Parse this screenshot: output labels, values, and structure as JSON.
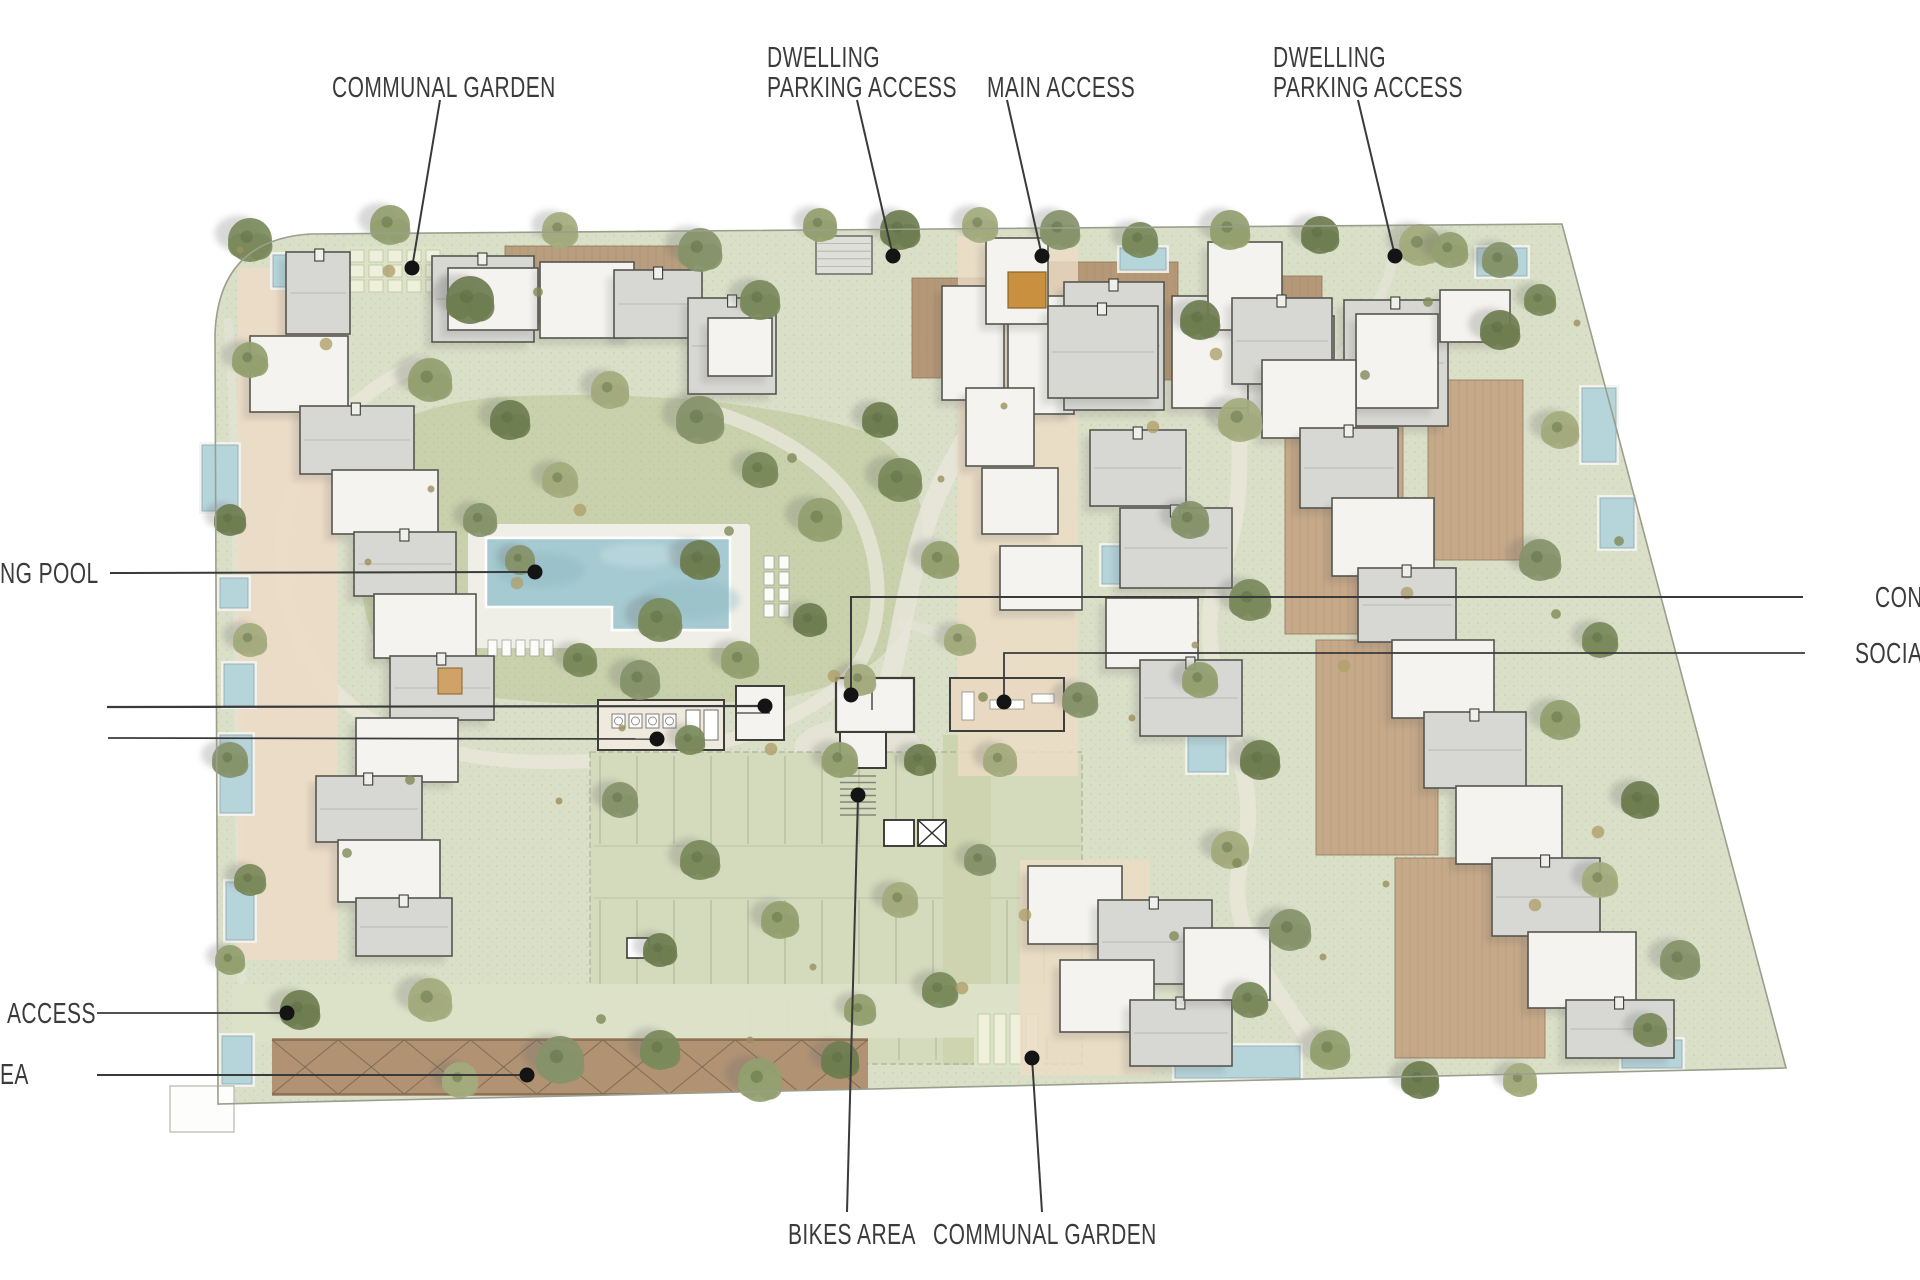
{
  "title": "Residential masterplan site plan",
  "annotations": {
    "communal_garden_top": {
      "label": "COMMUNAL GARDEN"
    },
    "dwelling_parking_left": {
      "line1": "DWELLING",
      "line2": "PARKING ACCESS"
    },
    "main_access": {
      "label": "MAIN ACCESS"
    },
    "dwelling_parking_right": {
      "line1": "DWELLING",
      "line2": "PARKING ACCESS"
    },
    "swimming_pool": {
      "label": "NG POOL"
    },
    "access": {
      "label": "ACCESS"
    },
    "area": {
      "label": "EA"
    },
    "concierge": {
      "label": "CON"
    },
    "social": {
      "label": "SOCIA"
    },
    "bikes_area": {
      "label": "BIKES AREA"
    },
    "communal_garden_bottom": {
      "label": "COMMUNAL GARDEN"
    }
  },
  "palette": {
    "site_green": "#dadfc8",
    "lawn_green": "#c5cfa7",
    "parking_green": "#d4dabc",
    "aisle_green": "#ccd4ae",
    "lane_green": "#dce1c8",
    "path_grey": "#e8e6da",
    "plaza_grey": "#e6e4d7",
    "deck_beige": "#ecdcc6",
    "deck_brown": "#b29573",
    "deck_brown2": "#b79b7b",
    "deck_tan": "#c5a786",
    "pergola_brown": "#b19374",
    "pergola_line": "#7e6a52",
    "building_white": "#f4f3ef",
    "building_grey": "#d7d8d4",
    "building_stroke": "#55564f",
    "pool_water": "#a6cad1",
    "pool_small": "#b6d5db",
    "pool_shade": "#8fb9c2",
    "gate_orange": "#c9913f",
    "allotment_bed": "#eef0dc",
    "allotment_bg": "#dde3c8",
    "grid_line": "#a3aa8f",
    "boundary": "#9b9e8d",
    "tree_greens": [
      "#7a8a5b",
      "#93a06f",
      "#6e7d50",
      "#a3ab7d",
      "#86936a"
    ],
    "shrub_tones": [
      "#9c8f5e",
      "#7f8a57",
      "#b0a06b"
    ],
    "leader_line": "#3a3a3a",
    "leader_dot": "#141414",
    "label_text": "#3b3b3b"
  }
}
